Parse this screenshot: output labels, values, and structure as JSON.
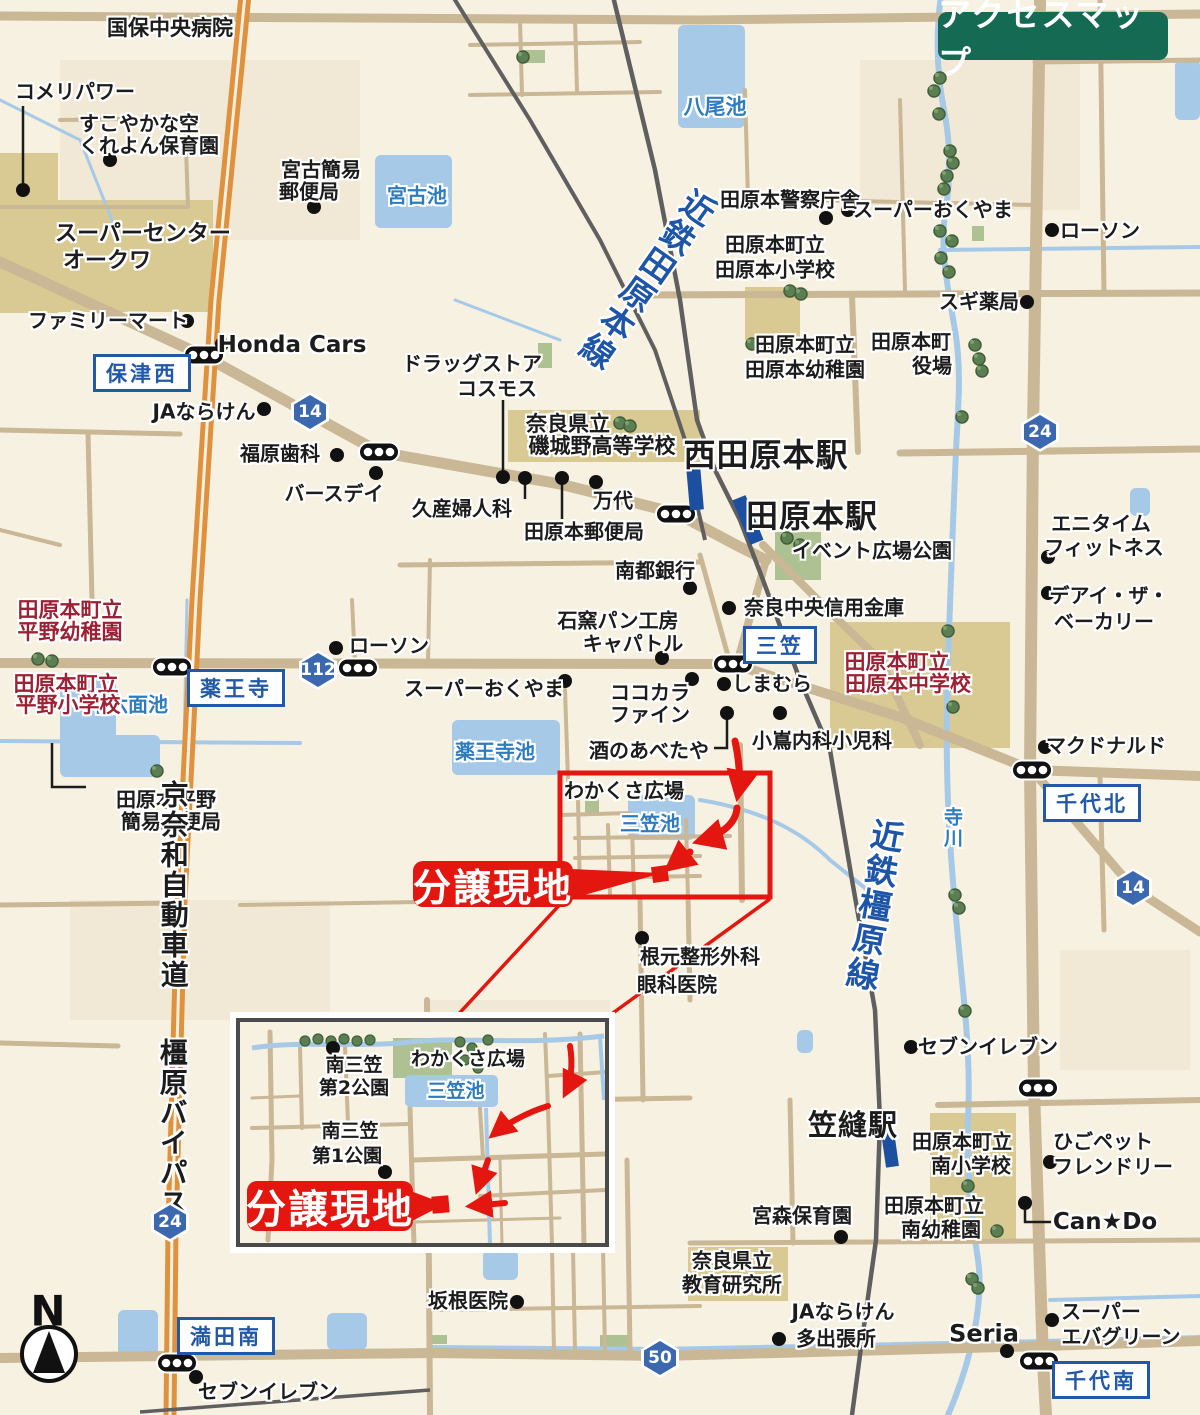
{
  "title_badge": {
    "label": "アクセスマップ",
    "bg": "#156a54"
  },
  "north_label": "N",
  "site_badge_main": {
    "label": "分譲現地",
    "x": 493,
    "y": 884,
    "w": 160,
    "h": 46,
    "fs": 38
  },
  "site_badge_inset": {
    "label": "分譲現地",
    "x": 330,
    "y": 1206,
    "w": 166,
    "h": 50,
    "fs": 40
  },
  "colors": {
    "red": "#e3170f",
    "school_red": "#9c2134",
    "water_blue": "#2e7cc0",
    "rail_blue": "#1d55a8",
    "badge_blue": "#2159a8",
    "title_green": "#156a54",
    "road_tan": "#c9b795",
    "highway_orange": "#e0913d",
    "station_blue": "#1c4f9f"
  },
  "railways": [
    {
      "name": "kintetsu-tawaramoto-line"
    },
    {
      "name": "kintetsu-kashihara-line"
    }
  ],
  "route_shields": [
    {
      "num": "14",
      "x": 310,
      "y": 412
    },
    {
      "num": "112",
      "x": 318,
      "y": 670
    },
    {
      "num": "24",
      "x": 1040,
      "y": 432
    },
    {
      "num": "14",
      "x": 1133,
      "y": 888
    },
    {
      "num": "24",
      "x": 170,
      "y": 1222
    },
    {
      "num": "50",
      "x": 660,
      "y": 1358
    }
  ],
  "intersection_badges": [
    {
      "t": "保津西",
      "x": 142,
      "y": 373
    },
    {
      "t": "薬王寺",
      "x": 236,
      "y": 688
    },
    {
      "t": "三笠",
      "x": 780,
      "y": 645
    },
    {
      "t": "千代北",
      "x": 1092,
      "y": 803
    },
    {
      "t": "満田南",
      "x": 226,
      "y": 1336
    },
    {
      "t": "千代南",
      "x": 1101,
      "y": 1380
    }
  ],
  "stations": [
    {
      "name": "西田原本駅",
      "x": 766,
      "y": 456,
      "fs": 32
    },
    {
      "name": "田原本駅",
      "x": 812,
      "y": 517,
      "fs": 32
    },
    {
      "name": "笠縫駅",
      "x": 853,
      "y": 1125,
      "fs": 29
    }
  ],
  "labels": [
    {
      "t": "国保中央病院",
      "x": 170,
      "y": 28,
      "fs": 21
    },
    {
      "t": "コメリパワー",
      "x": 75,
      "y": 92
    },
    {
      "t": "すこやかな空",
      "x": 139,
      "y": 124
    },
    {
      "t": "くれよん保育園",
      "x": 149,
      "y": 146
    },
    {
      "t": "宮古簡易",
      "x": 321,
      "y": 170
    },
    {
      "t": "郵便局",
      "x": 309,
      "y": 192
    },
    {
      "t": "宮古池",
      "x": 417,
      "y": 196,
      "cls": "b"
    },
    {
      "t": "八尾池",
      "x": 715,
      "y": 107,
      "cls": "b",
      "fs": 21
    },
    {
      "t": "田原本警察庁舎",
      "x": 790,
      "y": 200
    },
    {
      "t": "スーパーおくやま",
      "x": 933,
      "y": 210
    },
    {
      "t": "ローソン",
      "x": 1100,
      "y": 231
    },
    {
      "t": "田原本町立",
      "x": 775,
      "y": 245
    },
    {
      "t": "田原本小学校",
      "x": 775,
      "y": 270
    },
    {
      "t": "スギ薬局",
      "x": 979,
      "y": 302
    },
    {
      "t": "スーパーセンター",
      "x": 143,
      "y": 234,
      "fs": 22
    },
    {
      "t": "オークワ",
      "x": 107,
      "y": 261,
      "fs": 22
    },
    {
      "t": "ファミリーマート",
      "x": 108,
      "y": 321
    },
    {
      "t": "Honda Cars",
      "x": 292,
      "y": 345,
      "fs": 23
    },
    {
      "t": "JAならけん",
      "x": 204,
      "y": 412
    },
    {
      "t": "福原歯科",
      "x": 280,
      "y": 454
    },
    {
      "t": "バースデイ",
      "x": 334,
      "y": 494
    },
    {
      "t": "ドラッグストア",
      "x": 472,
      "y": 364
    },
    {
      "t": "コスモス",
      "x": 497,
      "y": 389
    },
    {
      "t": "久産婦人科",
      "x": 462,
      "y": 509
    },
    {
      "t": "万代",
      "x": 613,
      "y": 501
    },
    {
      "t": "田原本郵便局",
      "x": 584,
      "y": 532
    },
    {
      "t": "奈良県立",
      "x": 568,
      "y": 424,
      "fs": 21
    },
    {
      "t": "磯城野高等学校",
      "x": 602,
      "y": 446,
      "fs": 21
    },
    {
      "t": "イベント広場公園",
      "x": 872,
      "y": 551
    },
    {
      "t": "南都銀行",
      "x": 655,
      "y": 571
    },
    {
      "t": "奈良中央信用金庫",
      "x": 824,
      "y": 608
    },
    {
      "t": "エニタイム",
      "x": 1101,
      "y": 524
    },
    {
      "t": "フィットネス",
      "x": 1104,
      "y": 548
    },
    {
      "t": "デアイ・ザ・",
      "x": 1109,
      "y": 596
    },
    {
      "t": "ベーカリー",
      "x": 1104,
      "y": 622
    },
    {
      "t": "田原本町立",
      "x": 805,
      "y": 345
    },
    {
      "t": "田原本幼稚園",
      "x": 805,
      "y": 370
    },
    {
      "t": "田原本町",
      "x": 911,
      "y": 342
    },
    {
      "t": "役場",
      "x": 932,
      "y": 366
    },
    {
      "t": "マクドナルド",
      "x": 1106,
      "y": 746
    },
    {
      "t": "しまむら",
      "x": 772,
      "y": 684
    },
    {
      "t": "ココカラ",
      "x": 650,
      "y": 693
    },
    {
      "t": "ファイン",
      "x": 650,
      "y": 715
    },
    {
      "t": "酒のあべたや",
      "x": 649,
      "y": 751
    },
    {
      "t": "スーパーおくやま",
      "x": 484,
      "y": 689
    },
    {
      "t": "石窯パン工房",
      "x": 618,
      "y": 621
    },
    {
      "t": "キャパトル",
      "x": 633,
      "y": 644
    },
    {
      "t": "小嶌内科小児科",
      "x": 822,
      "y": 741
    },
    {
      "t": "田原本町立",
      "x": 897,
      "y": 662,
      "cls": "r",
      "fs": 21
    },
    {
      "t": "田原本中学校",
      "x": 908,
      "y": 684,
      "cls": "r",
      "fs": 21
    },
    {
      "t": "寺川",
      "x": 951,
      "y": 828,
      "cls": "b",
      "vert": 1,
      "fs": 19
    },
    {
      "t": "ローソン",
      "x": 389,
      "y": 646
    },
    {
      "t": "十六面池",
      "x": 128,
      "y": 705,
      "cls": "b"
    },
    {
      "t": "薬王寺池",
      "x": 495,
      "y": 752,
      "cls": "b"
    },
    {
      "t": "田原本町立",
      "x": 70,
      "y": 610,
      "cls": "r",
      "fs": 21
    },
    {
      "t": "平野幼稚園",
      "x": 70,
      "y": 632,
      "cls": "r",
      "fs": 21
    },
    {
      "t": "田原本町立",
      "x": 66,
      "y": 684,
      "cls": "r",
      "fs": 21
    },
    {
      "t": "平野小学校",
      "x": 68,
      "y": 705,
      "cls": "r",
      "fs": 21
    },
    {
      "t": "田原本平野",
      "x": 166,
      "y": 800
    },
    {
      "t": "簡易郵便局",
      "x": 171,
      "y": 822
    },
    {
      "t": "わかくさ広場",
      "x": 624,
      "y": 791
    },
    {
      "t": "三笠池",
      "x": 650,
      "y": 824,
      "cls": "b"
    },
    {
      "t": "根元整形外科",
      "x": 700,
      "y": 957
    },
    {
      "t": "眼科医院",
      "x": 677,
      "y": 985
    },
    {
      "t": "セブンイレブン",
      "x": 988,
      "y": 1047
    },
    {
      "t": "田原本町立",
      "x": 962,
      "y": 1142
    },
    {
      "t": "南小学校",
      "x": 971,
      "y": 1166
    },
    {
      "t": "ひごペット",
      "x": 1103,
      "y": 1142
    },
    {
      "t": "フレンドリー",
      "x": 1113,
      "y": 1167
    },
    {
      "t": "田原本町立",
      "x": 934,
      "y": 1206
    },
    {
      "t": "南幼稚園",
      "x": 941,
      "y": 1230
    },
    {
      "t": "Can★Do",
      "x": 1105,
      "y": 1222,
      "fs": 23
    },
    {
      "t": "宮森保育園",
      "x": 802,
      "y": 1216
    },
    {
      "t": "奈良県立",
      "x": 732,
      "y": 1261
    },
    {
      "t": "教育研究所",
      "x": 732,
      "y": 1285
    },
    {
      "t": "JAならけん",
      "x": 843,
      "y": 1312
    },
    {
      "t": "多出張所",
      "x": 836,
      "y": 1339
    },
    {
      "t": "坂根医院",
      "x": 468,
      "y": 1301
    },
    {
      "t": "Seria",
      "x": 984,
      "y": 1334,
      "fs": 24
    },
    {
      "t": "スーパー",
      "x": 1101,
      "y": 1312
    },
    {
      "t": "エバグリーン",
      "x": 1121,
      "y": 1337
    },
    {
      "t": "セブンイレブン",
      "x": 268,
      "y": 1392
    },
    {
      "t": "京奈和自動車道",
      "x": 173,
      "y": 885,
      "vert": 1,
      "fs": 28
    },
    {
      "t": "橿原バイパス",
      "x": 172,
      "y": 1128,
      "vert": 1,
      "fs": 28
    },
    {
      "t": "近鉄田原本線",
      "x": 645,
      "y": 278,
      "cls": "rb",
      "vert": 1,
      "fs": 33,
      "rot": 35
    },
    {
      "t": "近鉄橿原線",
      "x": 872,
      "y": 905,
      "cls": "rb",
      "vert": 1,
      "fs": 33,
      "rot": 10
    },
    {
      "t": "わかくさ広場",
      "x": 468,
      "y": 1060,
      "fs": 19
    },
    {
      "t": "三笠池",
      "x": 456,
      "y": 1092,
      "cls": "b",
      "fs": 19
    },
    {
      "t": "南三笠",
      "x": 354,
      "y": 1066,
      "fs": 19
    },
    {
      "t": "第2公園",
      "x": 354,
      "y": 1089,
      "fs": 19
    },
    {
      "t": "南三笠",
      "x": 350,
      "y": 1132,
      "fs": 19
    },
    {
      "t": "第1公園",
      "x": 347,
      "y": 1157,
      "fs": 19
    }
  ],
  "poi_dots": [
    [
      110,
      160
    ],
    [
      23,
      190
    ],
    [
      314,
      207
    ],
    [
      826,
      218
    ],
    [
      848,
      210
    ],
    [
      1052,
      230
    ],
    [
      1027,
      302
    ],
    [
      187,
      321
    ],
    [
      222,
      344
    ],
    [
      264,
      409
    ],
    [
      337,
      455
    ],
    [
      376,
      473
    ],
    [
      503,
      477
    ],
    [
      525,
      478
    ],
    [
      562,
      478
    ],
    [
      596,
      482
    ],
    [
      690,
      588
    ],
    [
      729,
      608
    ],
    [
      692,
      679
    ],
    [
      565,
      681
    ],
    [
      662,
      658
    ],
    [
      727,
      713
    ],
    [
      780,
      713
    ],
    [
      336,
      648
    ],
    [
      1048,
      557
    ],
    [
      1048,
      593
    ],
    [
      1045,
      747
    ],
    [
      724,
      684
    ],
    [
      642,
      938
    ],
    [
      911,
      1047
    ],
    [
      1050,
      1162
    ],
    [
      1025,
      1203
    ],
    [
      841,
      1237
    ],
    [
      779,
      1339
    ],
    [
      517,
      1302
    ],
    [
      1007,
      1351
    ],
    [
      1052,
      1320
    ],
    [
      196,
      1377
    ],
    [
      333,
      1048
    ],
    [
      385,
      1172
    ]
  ],
  "traffic_lights": [
    [
      204,
      355
    ],
    [
      379,
      452
    ],
    [
      676,
      514
    ],
    [
      172,
      667
    ],
    [
      358,
      668
    ],
    [
      733,
      664
    ],
    [
      1032,
      770
    ],
    [
      1038,
      1088
    ],
    [
      177,
      1363
    ],
    [
      1039,
      1361
    ]
  ],
  "pond_names": [
    "八尾池",
    "宮古池",
    "十六面池",
    "薬王寺池",
    "三笠池"
  ],
  "river_name": "寺川"
}
